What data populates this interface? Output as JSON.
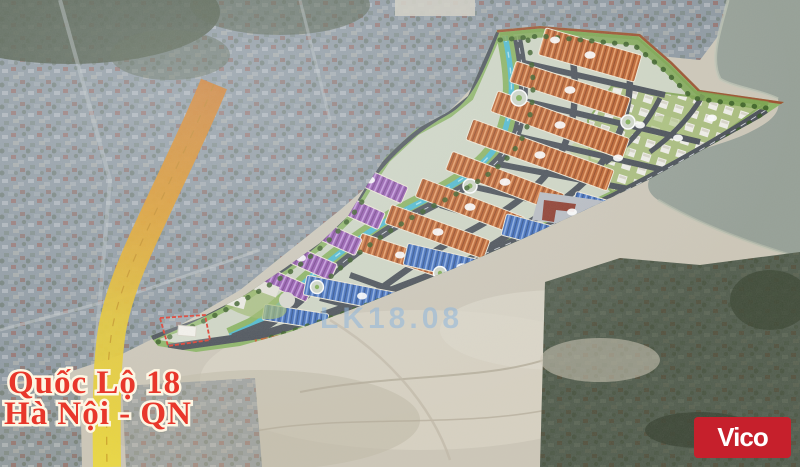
{
  "image": {
    "kind": "aerial-photo-with-masterplan-overlay",
    "width_px": 800,
    "height_px": 467
  },
  "overlay_labels": {
    "highway_name_line1": "Quốc Lộ 18",
    "highway_name_line2": "Hà Nội - QN",
    "plot_code": "LK18.08"
  },
  "branding": {
    "logo_text": "Vico",
    "logo_bg": "#c6202c",
    "logo_fg": "#ffffff"
  },
  "map_colors": {
    "highway_label_red": "#e8372b",
    "highway_overlay_orange": "#d4761c",
    "highway_overlay_yellow": "#ecd93e",
    "plot_code_blue": "#8fb6dc",
    "townhouse_orange": "#bc5f2a",
    "shophouse_purple": "#9455ae",
    "liner_blue": "#3d6bbd",
    "canal_cyan": "#4ab9d0",
    "plan_green": "#7fae52",
    "boundary_redbrown": "#9c4f2c",
    "river_gray_green": "#96a097",
    "sand": "#cdc7b8",
    "urban_haze": "#8d98a1"
  }
}
